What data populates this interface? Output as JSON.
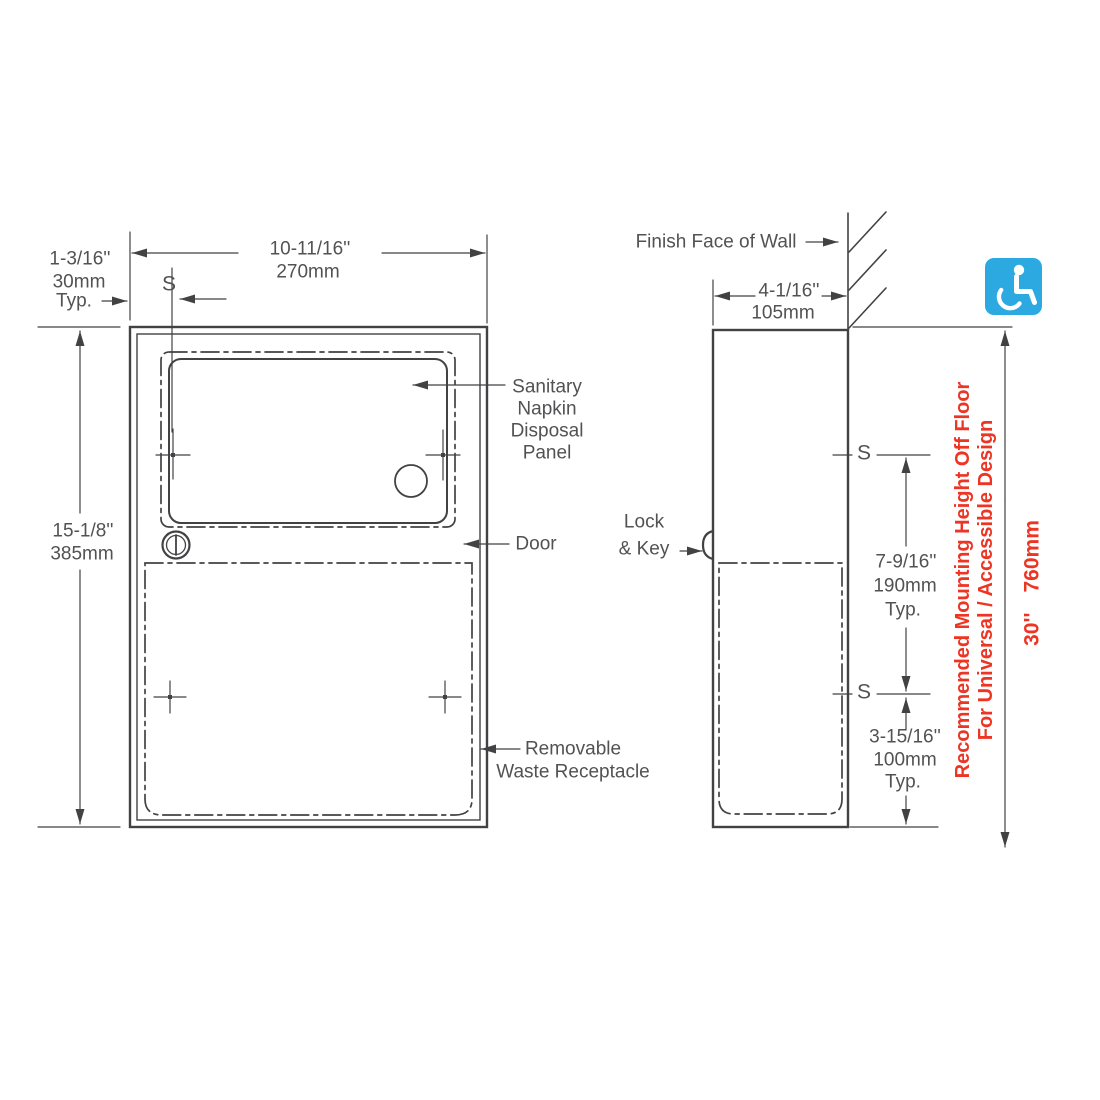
{
  "colors": {
    "accent_red": "#EE3524",
    "icon_blue": "#2BA9E0",
    "line_gray": "#424244"
  },
  "front_view": {
    "dim_width_in": "10-11/16''",
    "dim_width_mm": "270mm",
    "dim_edge_in": "1-3/16''",
    "dim_edge_mm": "30mm",
    "dim_edge_typ": "Typ.",
    "screw_marker": "S",
    "dim_height_in": "15-1/8''",
    "dim_height_mm": "385mm",
    "panel_label": [
      "Sanitary",
      "Napkin",
      "Disposal",
      "Panel"
    ],
    "door_label": "Door",
    "receptacle_label": [
      "Removable",
      "Waste Receptacle"
    ]
  },
  "side_view": {
    "wall_label": "Finish Face of Wall",
    "dim_depth_in": "4-1/16''",
    "dim_depth_mm": "105mm",
    "lock_label": [
      "Lock",
      "& Key"
    ],
    "screw_marker": "S",
    "dim_screw_in": "7-9/16''",
    "dim_screw_mm": "190mm",
    "dim_screw_typ": "Typ.",
    "dim_bottom_in": "3-15/16''",
    "dim_bottom_mm": "100mm",
    "dim_bottom_typ": "Typ."
  },
  "mounting_note": {
    "line1": "Recommended Mounting Height Off Floor",
    "line2": "For Universal / Accessible Design",
    "height_in": "30''",
    "height_mm": "760mm"
  },
  "icons": {
    "accessible": "wheelchair-accessible-icon"
  }
}
